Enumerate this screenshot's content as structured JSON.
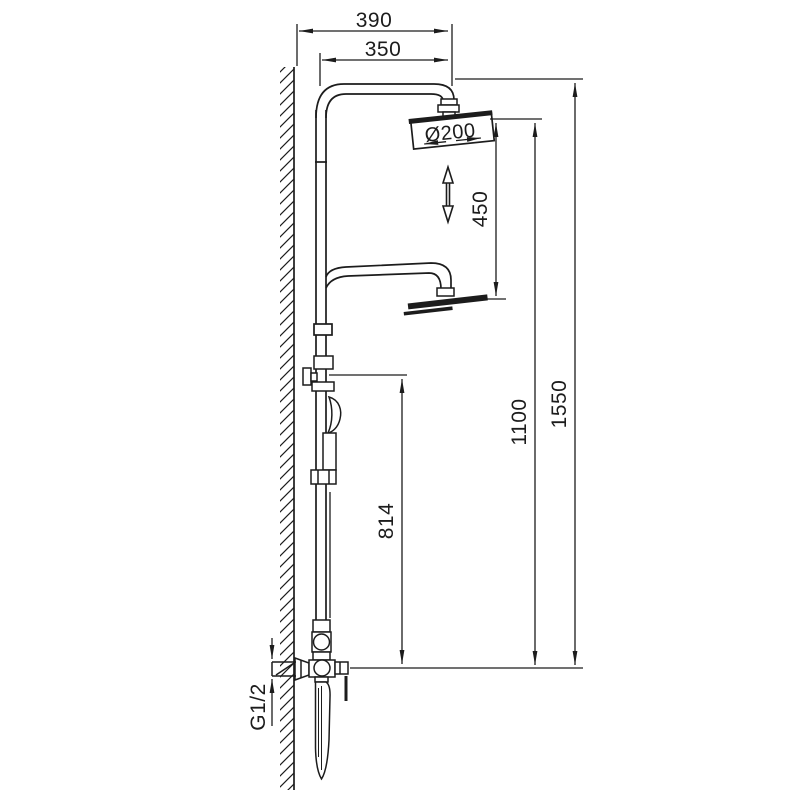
{
  "labels": {
    "dim_width_overall": "390",
    "dim_width_arm": "350",
    "dim_head_diameter": "Ø200",
    "dim_head_to_lower_head": "450",
    "dim_slide_height": "814",
    "dim_valve_to_head": "1100",
    "dim_total_height": "1550",
    "dim_inlet_thread": "G1/2"
  },
  "colors": {
    "line": "#1c1c1c",
    "background": "#ffffff"
  }
}
